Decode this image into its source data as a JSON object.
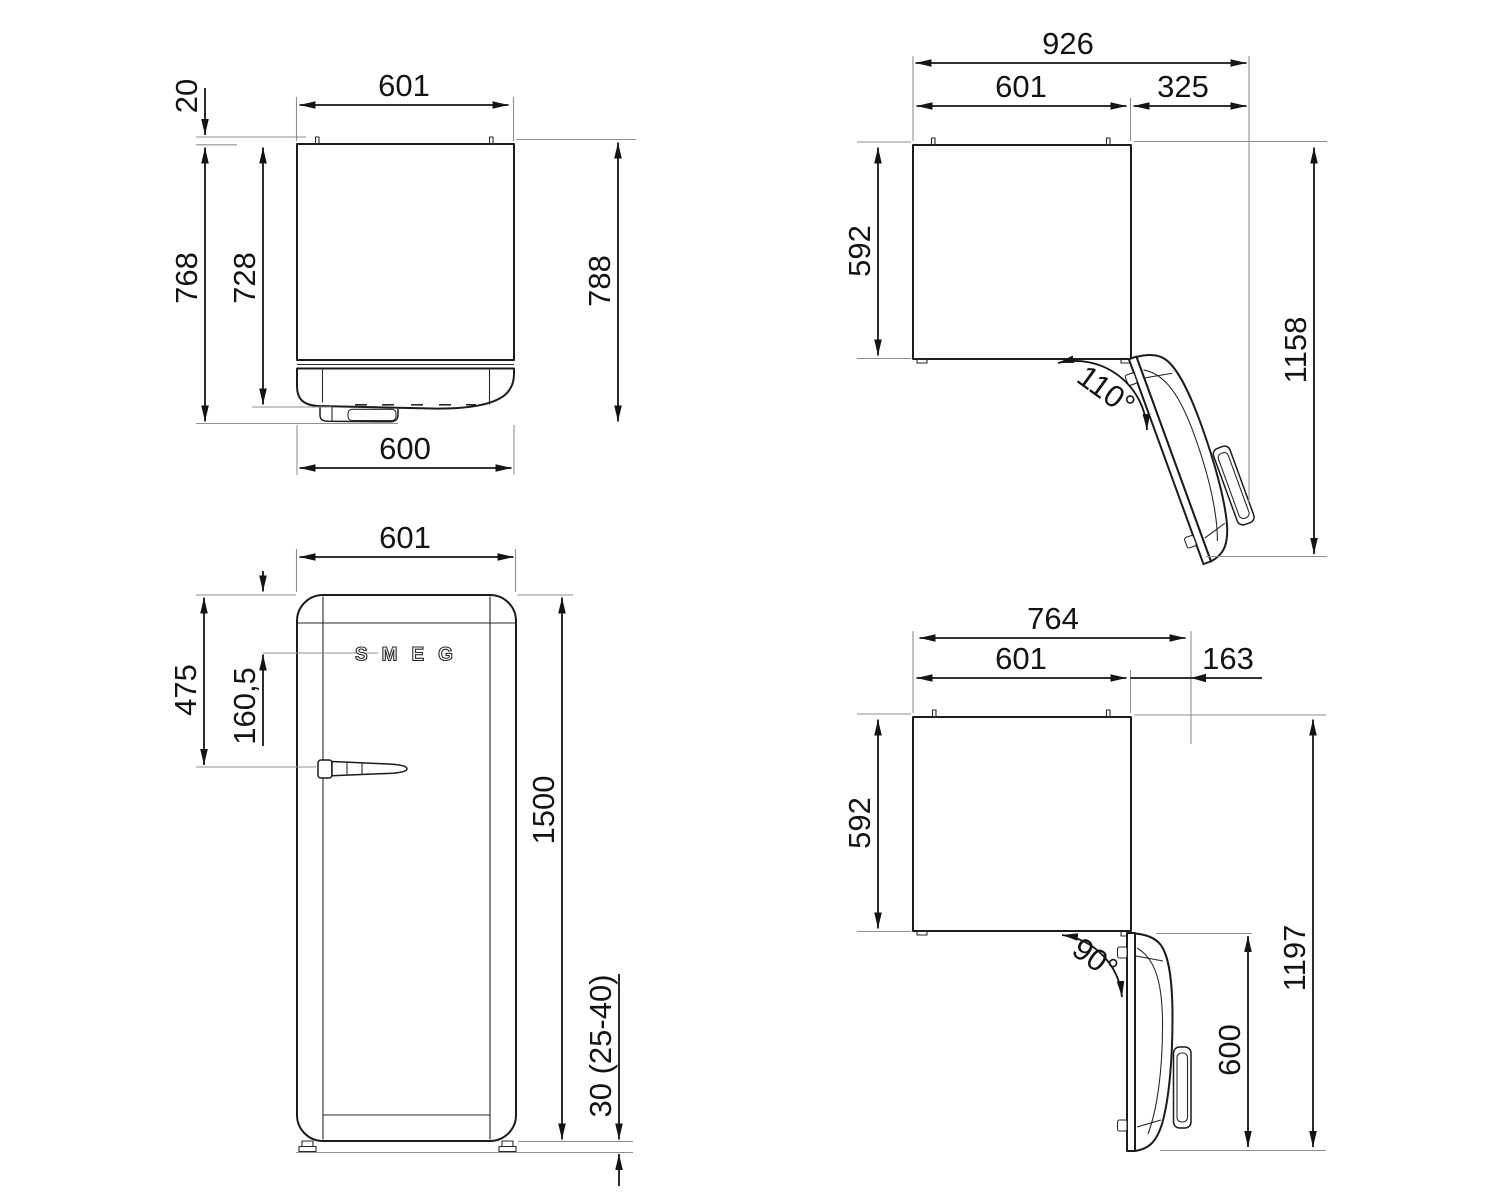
{
  "diagram": {
    "brand": "SMEG",
    "views": {
      "top_closed": {
        "width_top": "601",
        "hinge_offset": "20",
        "depth_no_door": "728",
        "depth_with_handle": "768",
        "depth_total": "788",
        "width_bottom": "600"
      },
      "top_open_110": {
        "overall_width": "926",
        "cabinet_width": "601",
        "door_clearance": "325",
        "cabinet_depth": "592",
        "overall_depth_open": "1158",
        "opening_angle": "110°"
      },
      "front": {
        "width": "601",
        "handle_from_top": "475",
        "logo_from_top": "160,5",
        "height": "1500",
        "feet_height": "30 (25-40)"
      },
      "top_open_90": {
        "overall_width": "764",
        "cabinet_width": "601",
        "door_clearance": "163",
        "cabinet_depth": "592",
        "overall_depth_open": "1197",
        "door_depth_open": "600",
        "opening_angle": "90°"
      }
    }
  }
}
